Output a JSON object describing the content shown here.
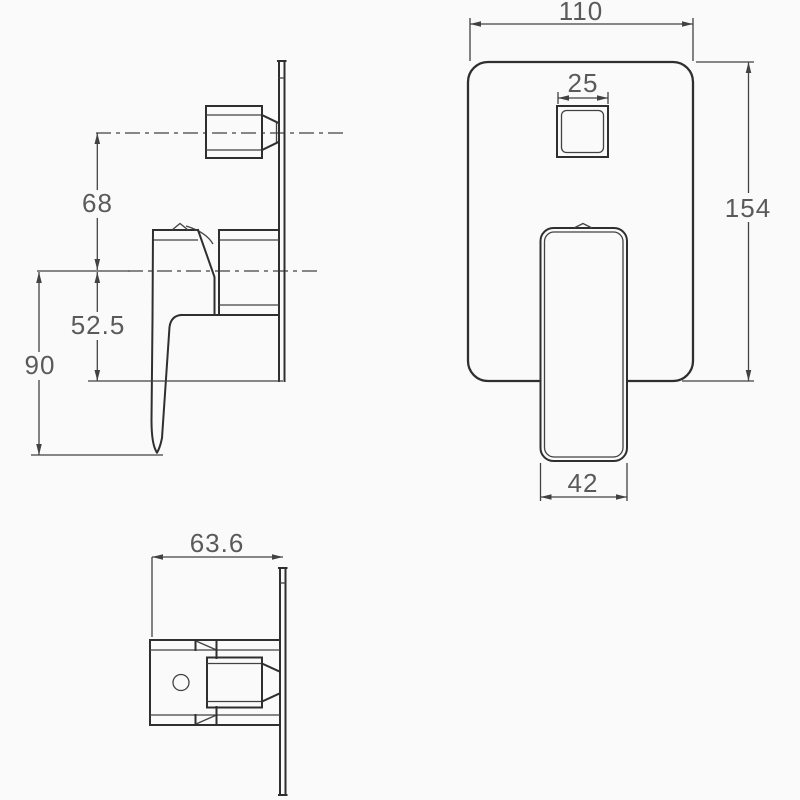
{
  "drawing": {
    "kind": "shower-mixer-valve-technical-drawing",
    "colors": {
      "background": "#fafafa",
      "line": "#2f2f2f",
      "thin_line": "#424242",
      "text": "#5a5a5a"
    },
    "views": {
      "side": {
        "labels": {
          "knob_center_offset": "68",
          "plate_bottom_offset": "52.5",
          "lever_bottom_offset": "90"
        }
      },
      "front": {
        "labels": {
          "plate_width": "110",
          "diverter_width": "25",
          "plate_height": "154",
          "handle_width": "42"
        }
      },
      "bottom": {
        "labels": {
          "total_depth": "63.6"
        }
      }
    }
  }
}
